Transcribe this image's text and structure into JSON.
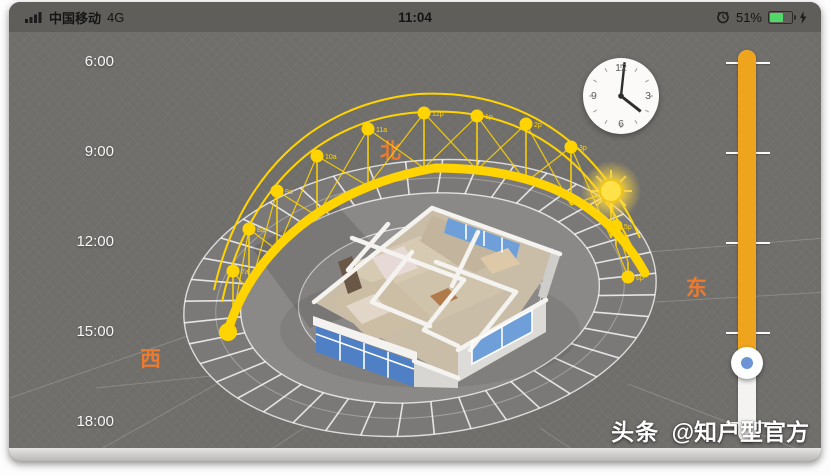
{
  "status_bar": {
    "carrier": "中国移动",
    "network": "4G",
    "time": "11:04",
    "battery_percent": "51%",
    "icons": [
      "signal-bars-icon",
      "alarm-clock-icon",
      "battery-icon",
      "charging-bolt-icon"
    ]
  },
  "scene": {
    "compass": {
      "north": "北",
      "west": "西",
      "east": "东"
    },
    "clock_widget": {
      "numerals": [
        "12",
        "3",
        "6",
        "9"
      ],
      "indicated_time": "4:00"
    },
    "sun_path": {
      "hour_markers": [
        "7a",
        "8a",
        "9a",
        "10a",
        "11a",
        "12p",
        "1p",
        "2p",
        "3p",
        "5p",
        "6p"
      ],
      "sun": "sun-icon"
    },
    "time_slider": {
      "tick_labels": [
        "6:00",
        "9:00",
        "12:00",
        "15:00",
        "18:00"
      ],
      "range_start": "6:00",
      "range_end": "18:00",
      "thumb_time": "16:00"
    },
    "watermark": {
      "brand": "头条",
      "handle": "@知户型官方"
    }
  },
  "colors": {
    "sun_path_yellow": "#ffd400",
    "slider_orange": "#efa41e",
    "compass_orange": "#ee7a2e",
    "battery_green": "#53d769",
    "window_blue": "#6f9fd8",
    "scene_gray": "#706e6b"
  }
}
